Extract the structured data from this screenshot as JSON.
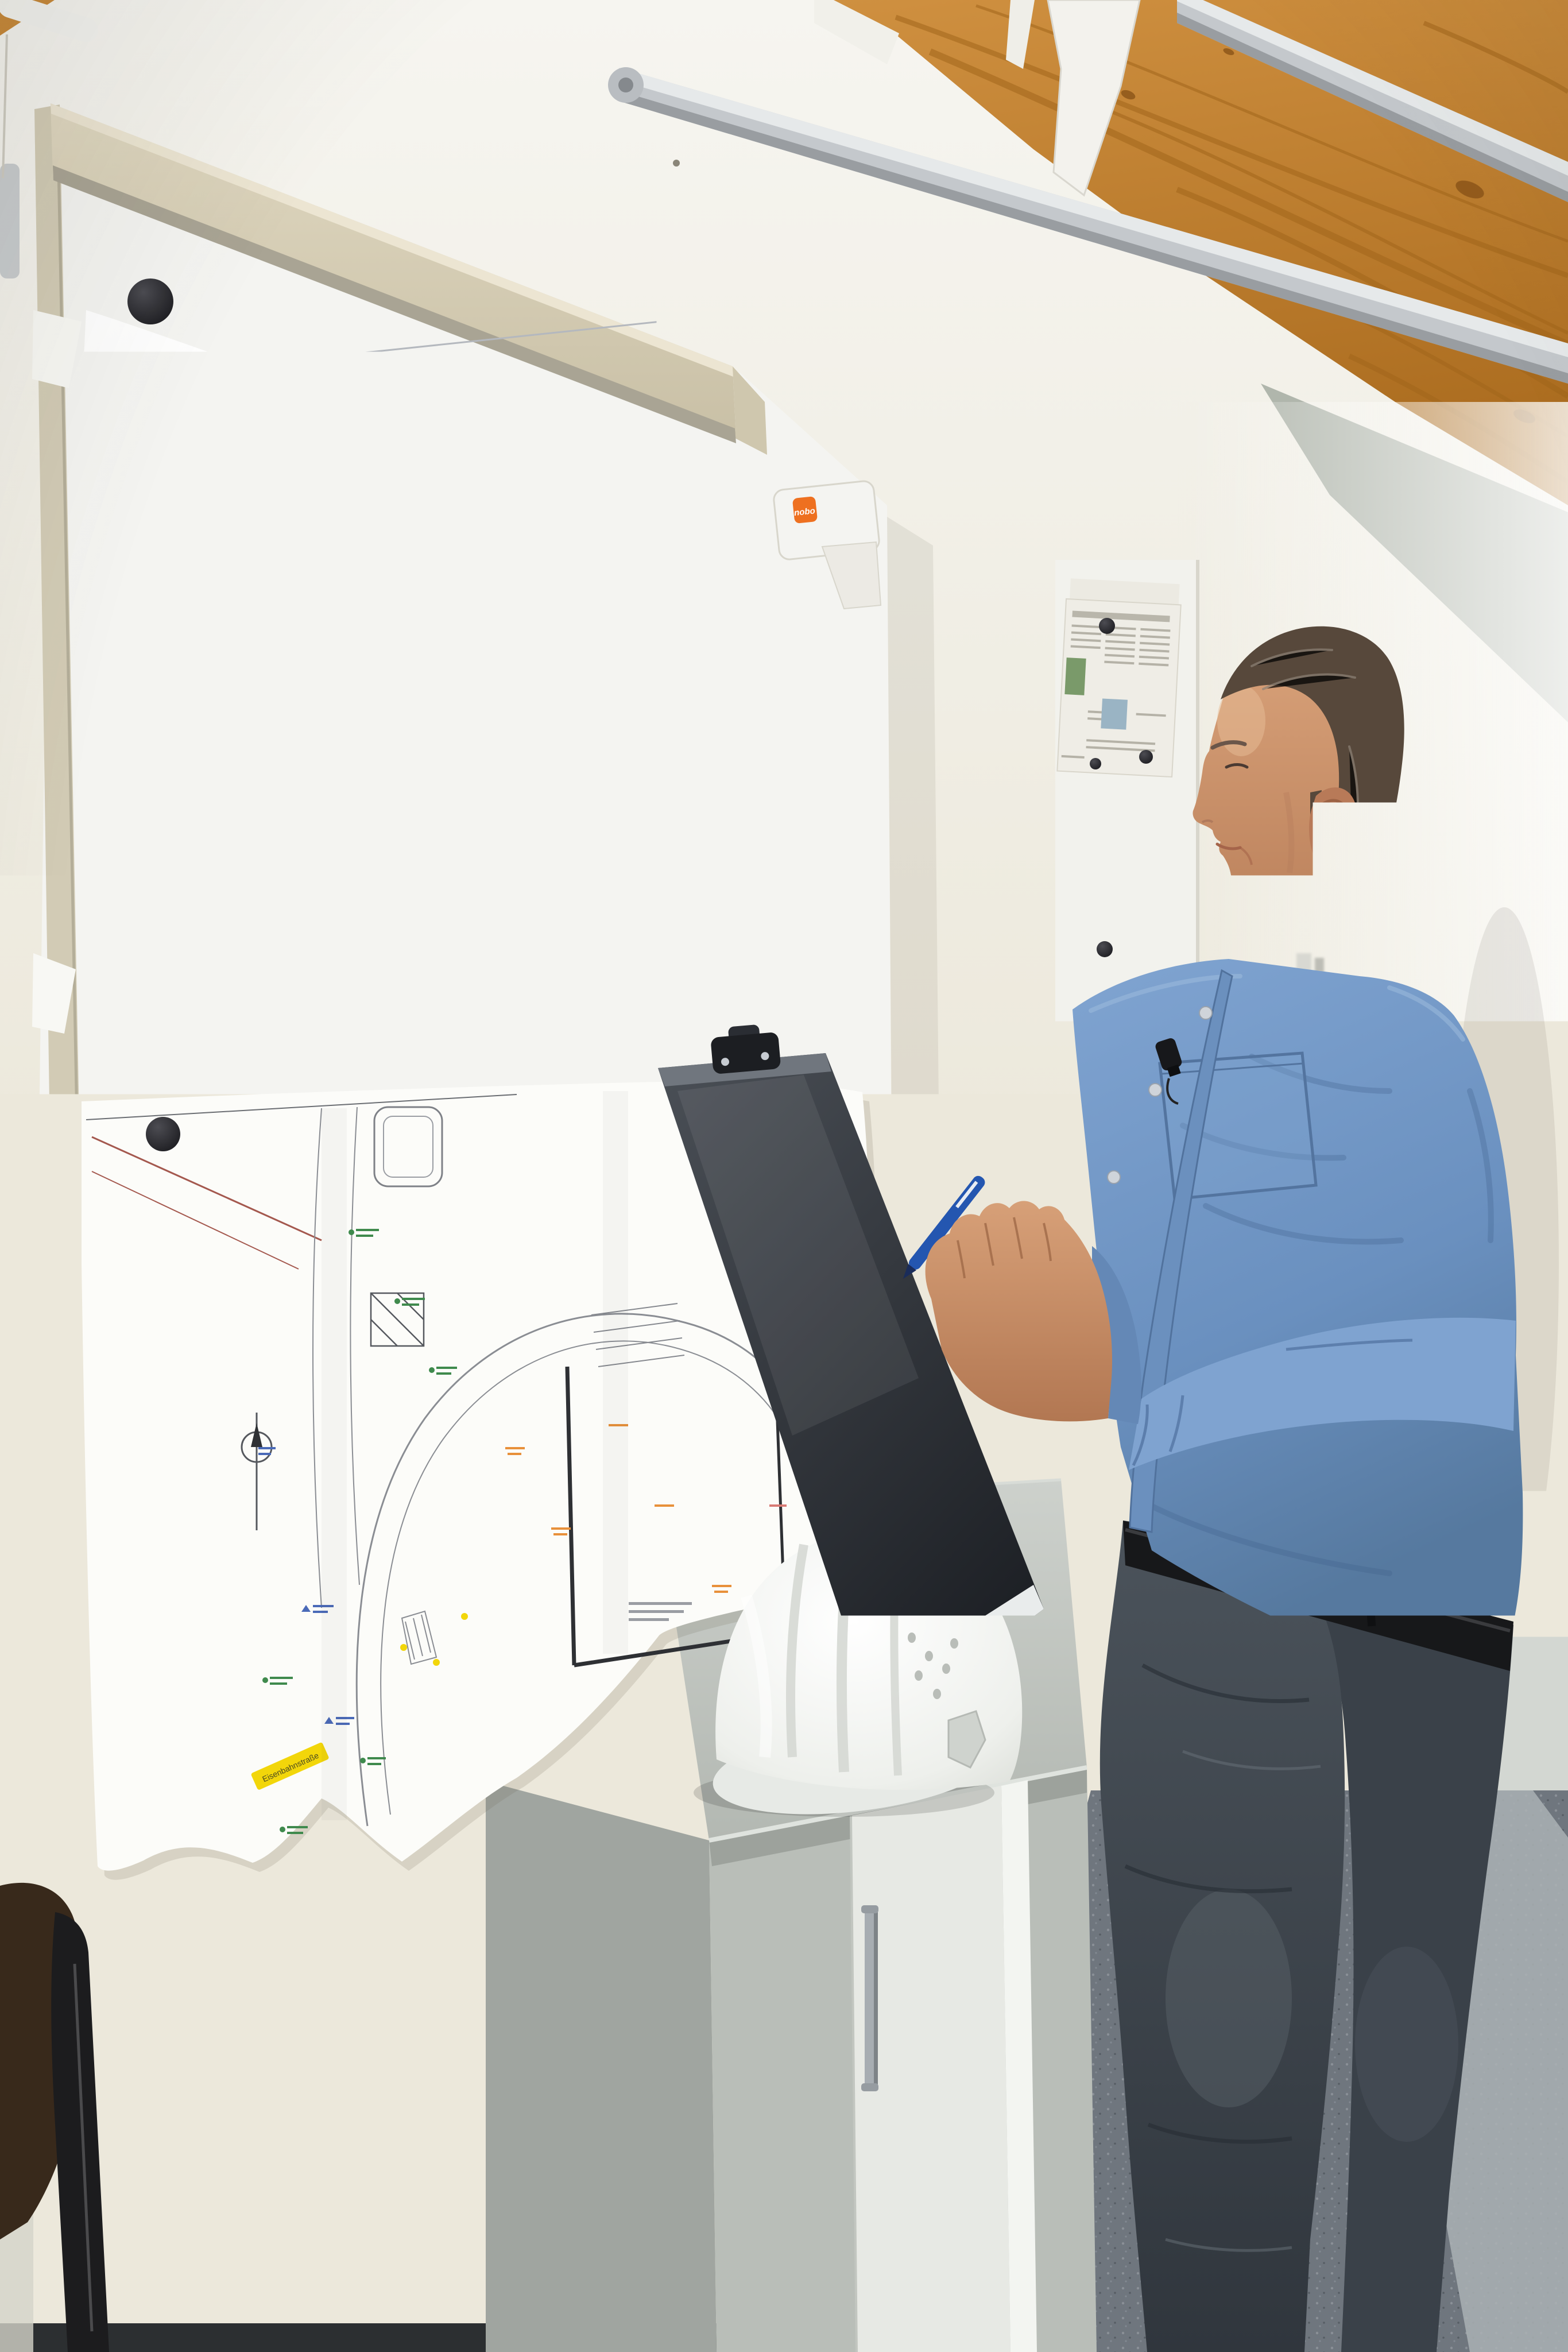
{
  "scene": {
    "type": "photograph",
    "subject": "construction manager in blue shirt reviewing site plans pinned to a whiteboard, writing on a clipboard",
    "lighting": "daylight from the right"
  },
  "colors": {
    "wall": "#ece8db",
    "wood_ceiling": "#c08231",
    "railing_metal": "#c4c8cc",
    "board_rail": "#d6ceb6",
    "board_surface": "#f4f4f1",
    "magnet": "#232327",
    "paper": "#fbfbf8",
    "carpet": "#737a82",
    "cabinet": "#b6bbb5",
    "hard_hat": "#f3f4f1",
    "shirt": "#6f94c2",
    "jeans": "#444b53",
    "skin": "#c9906f",
    "hair": "#57483b",
    "clipboard": "#33373d",
    "pen": "#2456b0",
    "highlight_yellow": "#f2d60a",
    "highlight_blue": "#4a7ad8",
    "nobo_orange": "#ee7020"
  },
  "whiteboard": {
    "bracket": {
      "brand": "nobo"
    },
    "magnet_count": 9
  },
  "site_plan": {
    "legend": {
      "title": "Legende",
      "swatches": [
        "#b9bdc5",
        "#ecd2a4",
        "#bd8d5c",
        "#abd073",
        "#8fd3ea",
        "#c5c9cf",
        "#e26a64",
        "#f5e6bd",
        "#d2e4ac",
        "#3f8a4d",
        "#8a5a3a"
      ]
    },
    "annotation": {
      "station": "4.02A",
      "km": "km = 0+006.960",
      "height": "hTS = 60.380 m",
      "slope": "1.87 ‰"
    },
    "features": {
      "pond_color": "#86d8ee",
      "pond_ring_color": "#a35c32",
      "meadow_color": "#aed478",
      "road_color": "#ecdcb0",
      "pad_color": "#a4a5ad",
      "lot_color": "#f4c488",
      "building_outline_color": "#c44c44"
    }
  },
  "strip_plan": {
    "street_label": "Eisenbahnstraße",
    "route_label": "B191",
    "corridor_color": "#d9bf8d"
  },
  "lower_plan": {
    "street_label": "Eisenbahnstraße"
  },
  "small_plan": {
    "ground_color": "#a6cc7e",
    "inner_color": "#ecd3a8",
    "building_color": "#c04848",
    "slab_color": "#8a92b8",
    "paving_color": "#a9adb4",
    "legend_swatches": [
      "#e8a050",
      "#8fbf62",
      "#d85a50",
      "#3a8a80"
    ]
  },
  "person": {
    "pose": "standing in profile facing the plans",
    "shirt": "light blue band-collar shirt",
    "accessories": [
      "lavalier microphone",
      "black belt",
      "belt transmitter",
      "blue pen",
      "black clipboard"
    ]
  },
  "furniture": {
    "cabinet": "light grey office cabinet",
    "chair": "dark brown chair back",
    "hard_hat": "white safety helmet on cabinet"
  },
  "outlets": {
    "count": 2
  }
}
